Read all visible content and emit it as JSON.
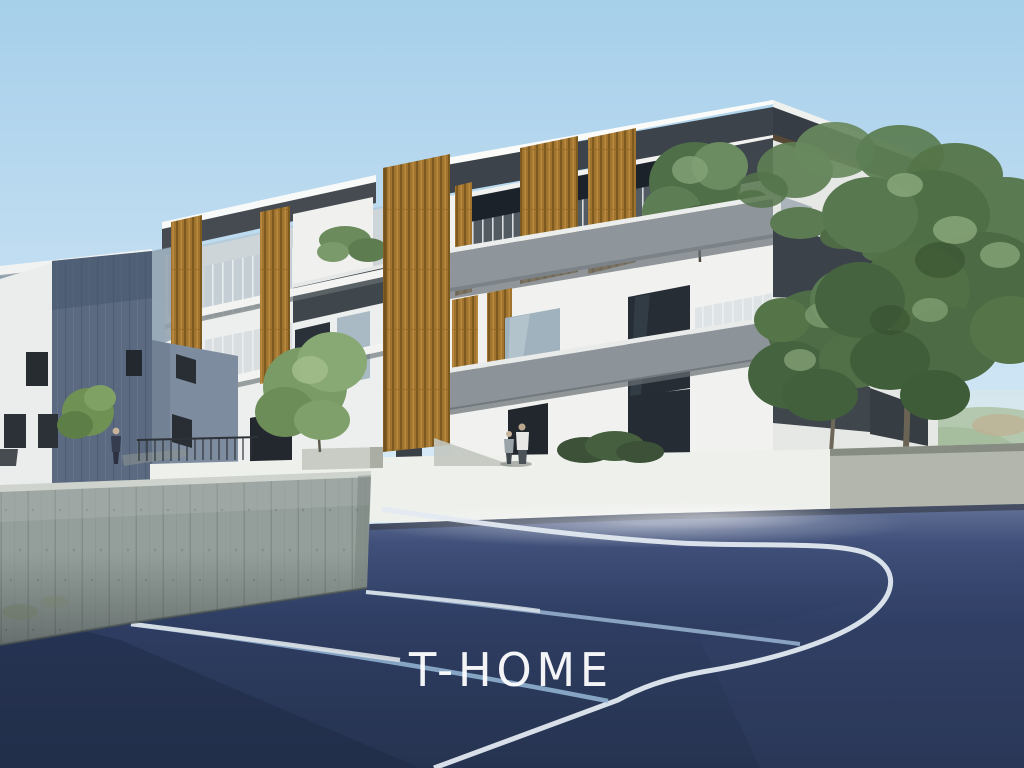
{
  "image": {
    "kind": "architectural rendering photograph (real-estate visualization)",
    "description": "Modern three-storey apartment building with vertical wood-slat screens and grey balcony parapets, seen from a dark blue asphalt sports court with white and pale-blue painted lines. A board-formed concrete retaining wall stands in the foreground left, large green trees on the right, a neighbouring slate-blue building on the left, small human figures on the walkway, and a hazy green hill in the far right distance under a clear light-blue sky.",
    "width": 1024,
    "height": 768
  },
  "watermark": {
    "text": "T-HOME",
    "color": "#ffffff"
  },
  "palette": {
    "sky_top": "#a6cfea",
    "sky_horizon": "#ddeef8",
    "building_white": "#f1f2f0",
    "fascia_dark": "#3d444b",
    "wood_slats": "#a0742e",
    "parapet_gray": "#8f969b",
    "left_building_panel": "#5b6a80",
    "boundary_wall_white": "#eef0ec",
    "retaining_wall_concrete": "#949e9a",
    "court_asphalt": "#2e3d62",
    "court_line_white": "#e2e9f1",
    "court_line_blue": "#9dbfde",
    "tree_foliage": "#55764d",
    "distant_hill": "#adc2a2"
  },
  "elements": {
    "main_building": "three-storey apartment block, flat white roof, dark fascia, wood slat screens, balcony trees",
    "left_building": "neighbouring building with large slate-blue wall panel and white wing",
    "boundary_wall": "low white site wall with dark metal fence and concrete planter",
    "retaining_wall": "tall board-formed concrete retaining wall in foreground",
    "court": "dark blue asphalt court with white sideline, three-point arc and two pale blue lines",
    "trees": "two large green trees right of centre, small tree in planter, bushes and hedges",
    "people": [
      "person in dark clothes standing on the left walkway",
      "two people talking near the building entrance, one in a white jacket"
    ],
    "hill": "soft green hill in the far right distance"
  }
}
